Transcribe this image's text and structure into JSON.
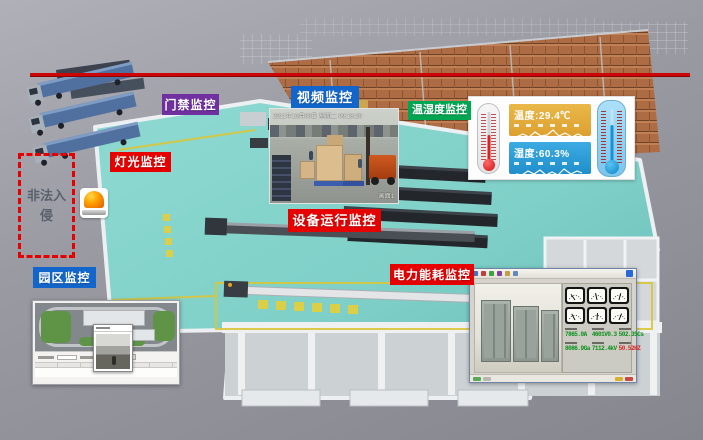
{
  "labels": {
    "door_access": "门禁监控",
    "video": "视频监控",
    "lighting": "灯光监控",
    "temp_humidity": "温湿度监控",
    "equipment": "设备运行监控",
    "power": "电力能耗监控",
    "park": "园区监控"
  },
  "intrusion": {
    "text": "非法入侵"
  },
  "video_monitor": {
    "timestamp": "2011年10月08日 星期二 09:18:20",
    "channel": "画面1"
  },
  "temp_humidity_panel": {
    "temperature": "温度:29.4℃",
    "humidity": "湿度:60.3%"
  },
  "power_panel": {
    "readings": [
      {
        "value": "7865.0A"
      },
      {
        "value": "4601V0.3"
      },
      {
        "value": "502.35Cs"
      },
      {
        "value": "8086.9Ga"
      },
      {
        "value": "7112.4kV"
      },
      {
        "value": "50.52HZ"
      }
    ]
  },
  "colors": {
    "label_red": "#e60000",
    "label_blue": "#1266cb",
    "label_purple": "#7030a0",
    "label_green": "#00a651",
    "alert_red": "#e60000",
    "floor_teal": "#7fd0c8",
    "temp_box": "#e2a63d",
    "humidity_box": "#2b9fd8"
  }
}
